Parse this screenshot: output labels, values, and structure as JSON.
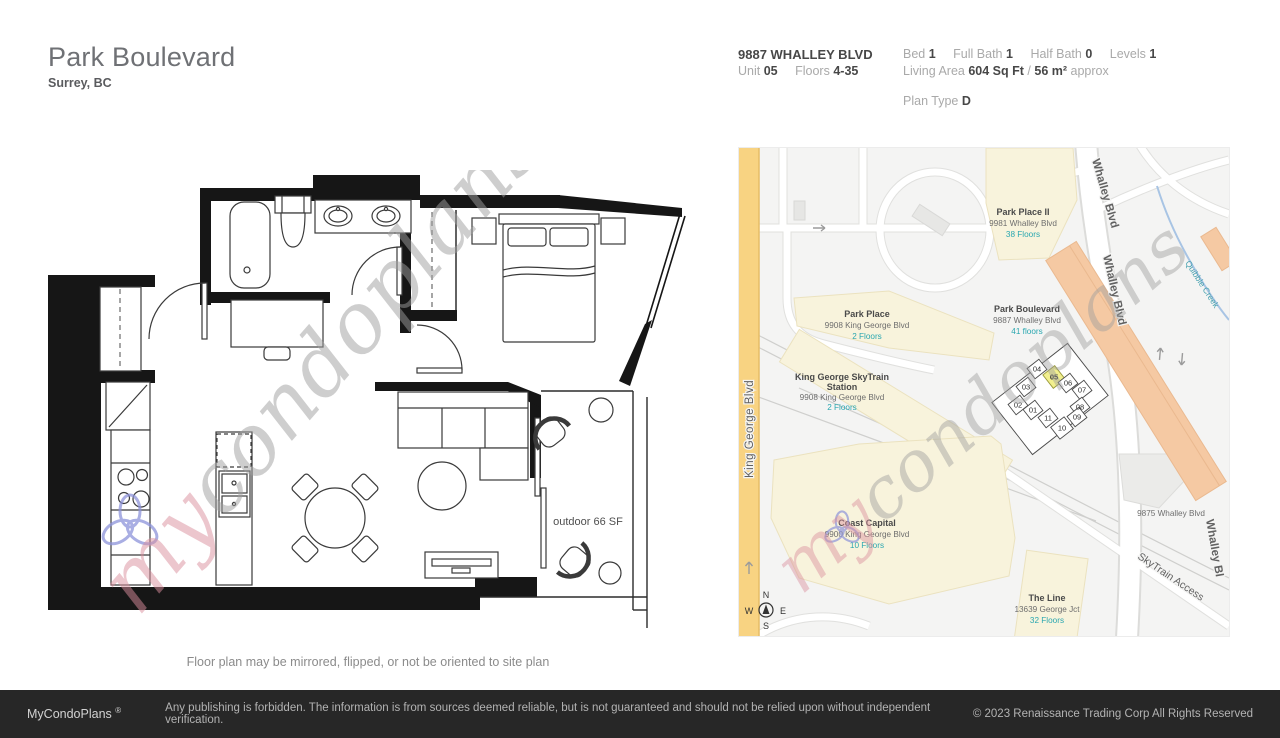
{
  "title": {
    "name": "Park Boulevard",
    "city": "Surrey, BC"
  },
  "specs": {
    "address": "9887 WHALLEY BLVD",
    "unit_label": "Unit",
    "unit": "05",
    "floors_label": "Floors",
    "floors": "4-35",
    "bed_label": "Bed",
    "bed": "1",
    "full_bath_label": "Full Bath",
    "full_bath": "1",
    "half_bath_label": "Half Bath",
    "half_bath": "0",
    "levels_label": "Levels",
    "levels": "1",
    "living_area_label": "Living Area",
    "living_area_sqft": "604 Sq Ft",
    "living_area_divider": "/",
    "living_area_m2": "56 m²",
    "living_area_approx": "approx",
    "plan_type_label": "Plan Type",
    "plan_type": "D"
  },
  "plan": {
    "outdoor": "outdoor 66 SF",
    "note": "Floor plan may be mirrored, flipped, or not be oriented to site plan"
  },
  "watermark": {
    "my": "my",
    "rest": "condoplans"
  },
  "map": {
    "road_king_george": "King George Blvd",
    "road_whalley_1": "Whalley Blvd",
    "road_whalley_2": "Whalley Blvd",
    "road_whalley_3": "Whalley Bl",
    "road_skytrain_access": "SkyTrain Access",
    "creek": "Quibble Creek",
    "label_9875": "9875 Whalley Blvd",
    "places": [
      {
        "name": "Park Place II",
        "address": "9981 Whalley Blvd",
        "floors": "38 Floors"
      },
      {
        "name": "Park Place",
        "address": "9908 King George Blvd",
        "floors": "2 Floors"
      },
      {
        "name": "King George SkyTrain",
        "name2": "Station",
        "address": "9908 King George Blvd",
        "floors": "2 Floors"
      },
      {
        "name": "Park Boulevard",
        "address": "9887 Whalley Blvd",
        "floors": "41 floors"
      },
      {
        "name": "Coast Capital",
        "address": "9900 King George Blvd",
        "floors": "10 Floors"
      },
      {
        "name": "The Line",
        "address": "13639 George Jct",
        "floors": "32 Floors"
      }
    ],
    "units": [
      "01",
      "02",
      "03",
      "04",
      "05",
      "06",
      "07",
      "08",
      "09",
      "10",
      "11"
    ],
    "highlighted_unit": "05",
    "compass": {
      "n": "N",
      "e": "E",
      "s": "S",
      "w": "W"
    },
    "colors": {
      "highlight_fill": "#f1ef8e",
      "major_road": "#f8d382",
      "building_fill": "#f8f3dc",
      "tower_fill": "#f5c9a3",
      "floors_text": "#2aa7b0"
    }
  },
  "footer": {
    "brand": "MyCondoPlans",
    "reg": "®",
    "disclaimer": "Any publishing is forbidden. The information is from sources deemed reliable, but is not guaranteed and should not be relied upon without independent verification.",
    "copyright": "© 2023 Renaissance Trading Corp  All Rights Reserved"
  }
}
